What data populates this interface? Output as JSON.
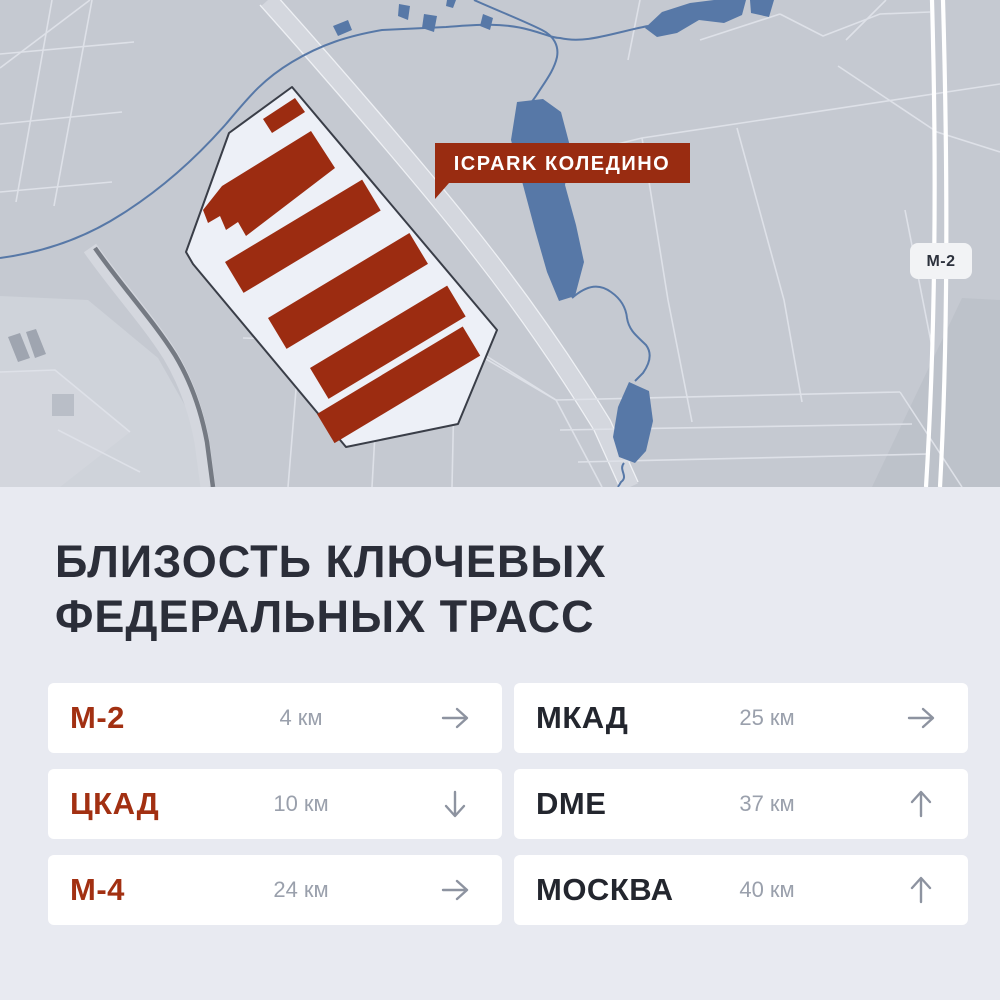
{
  "map": {
    "project_label": "ICPARK КОЛЕДИНО",
    "road_badge": "М-2",
    "colors": {
      "map_bg": "#c5c9d1",
      "parcel_line": "#dee1e8",
      "water": "#5778a7",
      "site_fill": "#edf0f7",
      "site_stroke": "#3a3e48",
      "building_red": "#9c2c11",
      "label_bg": "#992c11",
      "label_text": "#ffffff",
      "badge_bg": "#f2f3f5",
      "badge_text": "#2c313c",
      "road_corridor": "#d4d7de",
      "road_dark": "#757a83",
      "highway_white": "#ffffff"
    }
  },
  "panel": {
    "bg": "#e8eaf1",
    "title_line1": "БЛИЗОСТЬ КЛЮЧЕВЫХ",
    "title_line2": "ФЕДЕРАЛЬНЫХ ТРАСС",
    "title_color": "#2b2e39",
    "accent_red": "#a23012",
    "text_dark": "#23262e",
    "muted_text": "#9aa0ac",
    "arrow_color": "#8d93a0",
    "card_bg": "#ffffff",
    "cards": [
      {
        "label": "М-2",
        "distance": "4 км",
        "arrow": "right",
        "label_style": "red"
      },
      {
        "label": "МКАД",
        "distance": "25 км",
        "arrow": "right",
        "label_style": "dark"
      },
      {
        "label": "ЦКАД",
        "distance": "10 км",
        "arrow": "down",
        "label_style": "red"
      },
      {
        "label": "DME",
        "distance": "37 км",
        "arrow": "up",
        "label_style": "dark"
      },
      {
        "label": "М-4",
        "distance": "24 км",
        "arrow": "right",
        "label_style": "red"
      },
      {
        "label": "МОСКВА",
        "distance": "40 км",
        "arrow": "up",
        "label_style": "dark"
      }
    ]
  }
}
